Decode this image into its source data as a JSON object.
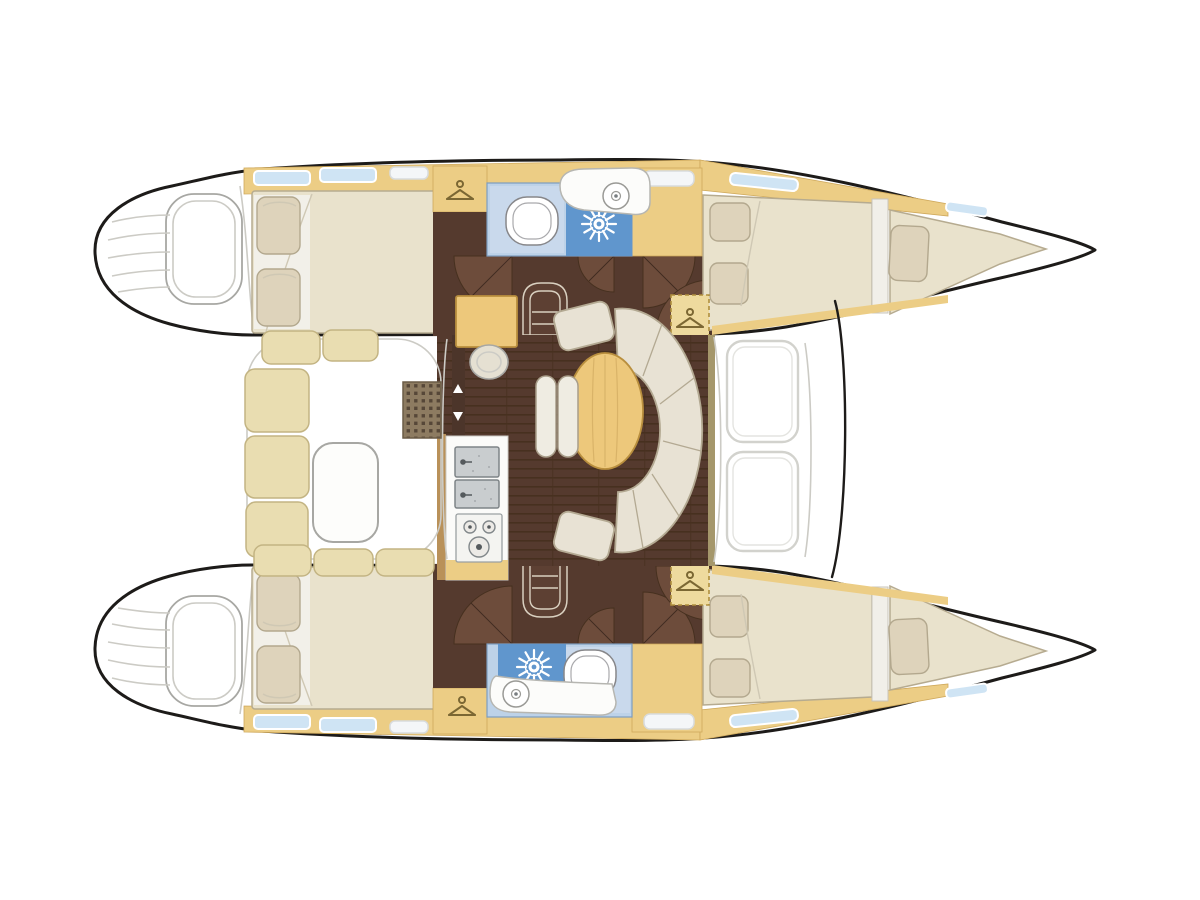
{
  "diagram": {
    "type": "boat-floor-plan",
    "subject": "catamaran interior layout, overhead view, bows to the right"
  },
  "colors": {
    "paper": "#ffffff",
    "hull_outline": "#1d1b19",
    "deck_wood": "#eccd85",
    "table_wood": "#edc87b",
    "mattress": "#e9e2cc",
    "mattress_edge": "#b6ab90",
    "pillow": "#ded3bb",
    "sofa": "#e8e2d4",
    "sofa_edge": "#b3a992",
    "floor_dark": "#553a2e",
    "floor_plank": "#47301f",
    "door_swing": "#6d4c3b",
    "bath_light": "#bdd2e8",
    "bath_zone": "#c9d9ec",
    "bath_dark": "#6096cd",
    "hatch_blue": "#cfe4f4",
    "steel": "#c9cdcf",
    "cockpit_bench": "#e9ddb1",
    "grate_wood": "#8d7b61",
    "detail_gray": "#a7a7a3",
    "faint_gray": "#cccbc5"
  },
  "icons": {
    "hanger": "clothes-hanger-in-locker",
    "shower": "sunburst-shower-rose",
    "toilet": "toilet-seat-top-view",
    "basin": "round-washbasin",
    "sink": "double-stainless-sink",
    "stove": "three-burner-hob",
    "steps": "companionway-steps",
    "door": "quarter-circle-door-swing"
  }
}
